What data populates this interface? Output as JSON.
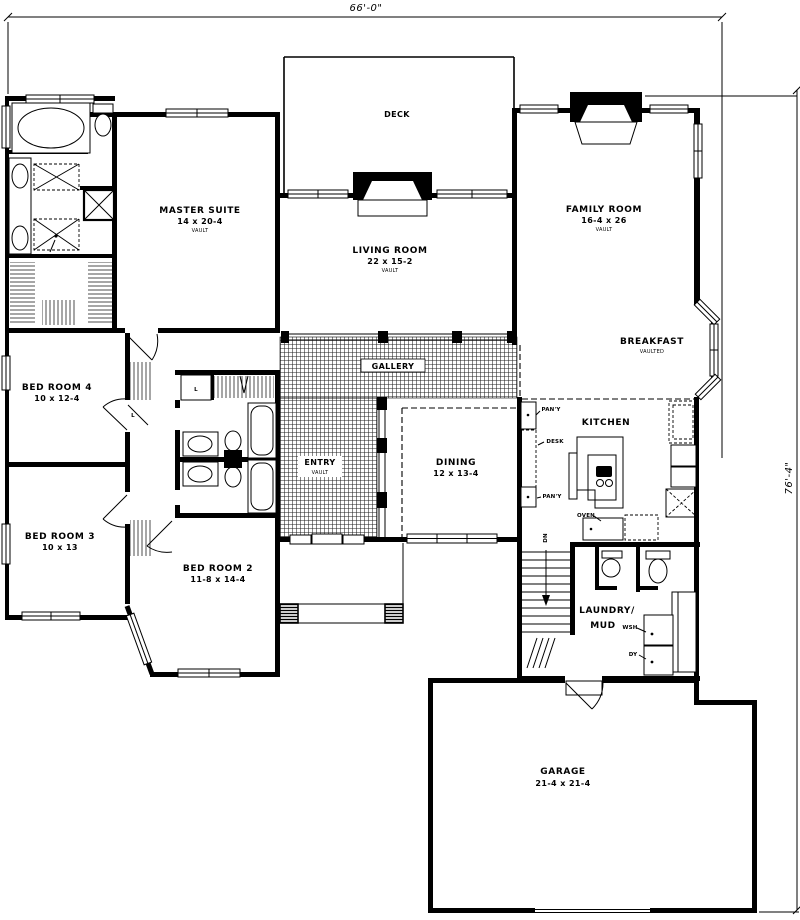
{
  "dims": {
    "width": "66'-0\"",
    "height": "76'-4\""
  },
  "rooms": {
    "deck": {
      "label": "DECK"
    },
    "master": {
      "label": "MASTER SUITE",
      "size": "14 x 20-4",
      "note": "VAULT"
    },
    "living": {
      "label": "LIVING ROOM",
      "size": "22 x 15-2",
      "note": "VAULT"
    },
    "family": {
      "label": "FAMILY ROOM",
      "size": "16-4 x 26",
      "note": "VAULT"
    },
    "breakfast": {
      "label": "BREAKFAST",
      "note": "VAULTED"
    },
    "gallery": {
      "label": "GALLERY"
    },
    "entry": {
      "label": "ENTRY",
      "note": "VAULT"
    },
    "dining": {
      "label": "DINING",
      "size": "12 x 13-4"
    },
    "kitchen": {
      "label": "KITCHEN"
    },
    "bedroom4": {
      "label": "BED ROOM 4",
      "size": "10 x 12-4"
    },
    "bedroom3": {
      "label": "BED ROOM 3",
      "size": "10 x 13"
    },
    "bedroom2": {
      "label": "BED ROOM 2",
      "size": "11-8 x 14-4"
    },
    "laundry": {
      "label": "LAUNDRY/",
      "label2": "MUD"
    },
    "garage": {
      "label": "GARAGE",
      "size": "21-4 x 21-4"
    }
  },
  "ann": {
    "pantry_upper": "PAN'Y",
    "desk": "DESK",
    "pantry_lower": "PAN'Y",
    "oven": "OVEN",
    "dn": "DN",
    "washer": "WSH",
    "dryer": "DY",
    "linen1": "L",
    "linen2": "L",
    "shower": "SHWR"
  }
}
